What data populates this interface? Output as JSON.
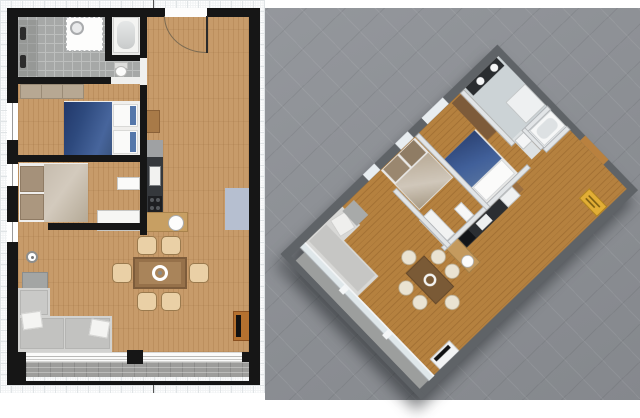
{
  "image": {
    "kind": "floor-plan presentation",
    "width_px": 640,
    "height_px": 418,
    "visible_text": "none"
  },
  "panels": {
    "plan2d": {
      "name": "2D top-down floor plan",
      "rooms": [
        {
          "name": "bathroom",
          "floor": "grey-tile",
          "fixtures": [
            "double-washbasin",
            "walk-in-shower"
          ]
        },
        {
          "name": "bathtub-room",
          "floor": "light",
          "fixtures": [
            "bathtub"
          ]
        },
        {
          "name": "toilet-nook",
          "floor": "grey-tile",
          "fixtures": [
            "toilet"
          ]
        },
        {
          "name": "entrance-hall",
          "floor": "wood",
          "fixtures": [
            "entrance-door-with-swing-arc"
          ]
        },
        {
          "name": "bedroom-1",
          "floor": "wood",
          "fixtures": [
            "double-bed-blue",
            "wardrobe-dresser"
          ]
        },
        {
          "name": "bedroom-2",
          "floor": "wood",
          "fixtures": [
            "double-bed-beige",
            "white-dresser"
          ]
        },
        {
          "name": "living-dining-kitchen",
          "floor": "wood",
          "fixtures": [
            "kitchen-counter",
            "cooktop",
            "sink",
            "kitchen-island-with-round-sink",
            "dishwasher",
            "tall-cabinet",
            "dining-table",
            "six-chairs",
            "corner-sofa",
            "side-table",
            "floor-lamp",
            "blue-rug",
            "tv-stand"
          ]
        },
        {
          "name": "balcony",
          "floor": "stone-tile",
          "fixtures": [
            "sliding-glass-door"
          ]
        }
      ],
      "window_count_left_wall": 3
    },
    "view3d": {
      "name": "3D aerial dollhouse view of same apartment",
      "rotation": "approx 46 degrees",
      "extras": [
        "yellow-doormat",
        "washing-machine",
        "fridge",
        "white-tv-console"
      ]
    }
  },
  "colors": {
    "grid_minor": "#f1f3f4",
    "grid_major": "#e0e4e6",
    "wall": "#161616",
    "wood2d": "#c79b6a",
    "tile": "#a6a8a7",
    "tile_grout": "#bcbebd",
    "tubfloor": "#eaeae8",
    "balcony": "#9d9d9b",
    "blue_duvet": "#2e4a7e",
    "blue_duvet2": "#47659c",
    "pillow_white": "#fafaf9",
    "bed2_duvet": "#c6bcae",
    "bed2_pillow": "#a5917a",
    "dresser": "#b7a893",
    "sofa": "#d2d2d0",
    "sofa_seat": "#c2c2c0",
    "table": "#96714a",
    "table_inner": "#a9845a",
    "chair": "#ead0a6",
    "chair_border": "#9a7a4e",
    "counter": "#35383c",
    "island": "#c79f63",
    "rug": "#b6bfd0",
    "tv_stand": "#b5712f",
    "cabinet": "#a87a48",
    "lamp": "#8e8e8c",
    "bg3d": "#8b8e93",
    "wall3d": "#5f6367",
    "partition3d": "#e2e5e7",
    "wood3d": "#b5813f",
    "bath3d": "#ccd3d6",
    "mat_yellow": "#e2ae35",
    "glass": "#dfe7ea",
    "white": "#ffffff"
  }
}
